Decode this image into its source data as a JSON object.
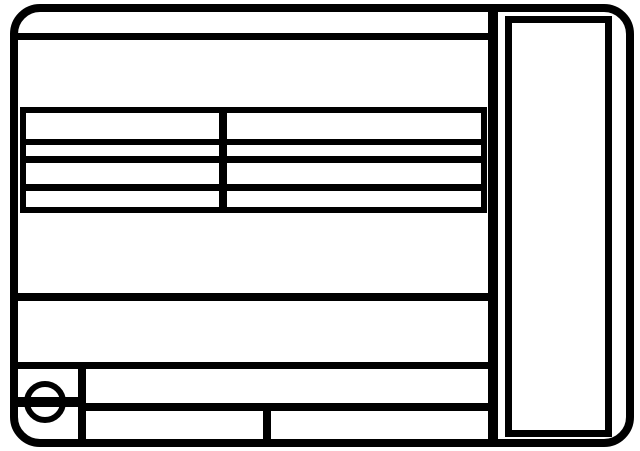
{
  "colors": {
    "background": "#ffffff",
    "line": "#000000"
  },
  "figure": {
    "kind": "blank-label-template-diagram",
    "text_content": "",
    "spec_table": {
      "rows": 4,
      "columns": 2,
      "all_cells_blank": true
    },
    "right_panel": {
      "content": "",
      "blank": true
    },
    "icons": [
      {
        "name": "slotted-screw-icon",
        "glyph": "circle-with-horizontal-slot-bar"
      }
    ]
  }
}
